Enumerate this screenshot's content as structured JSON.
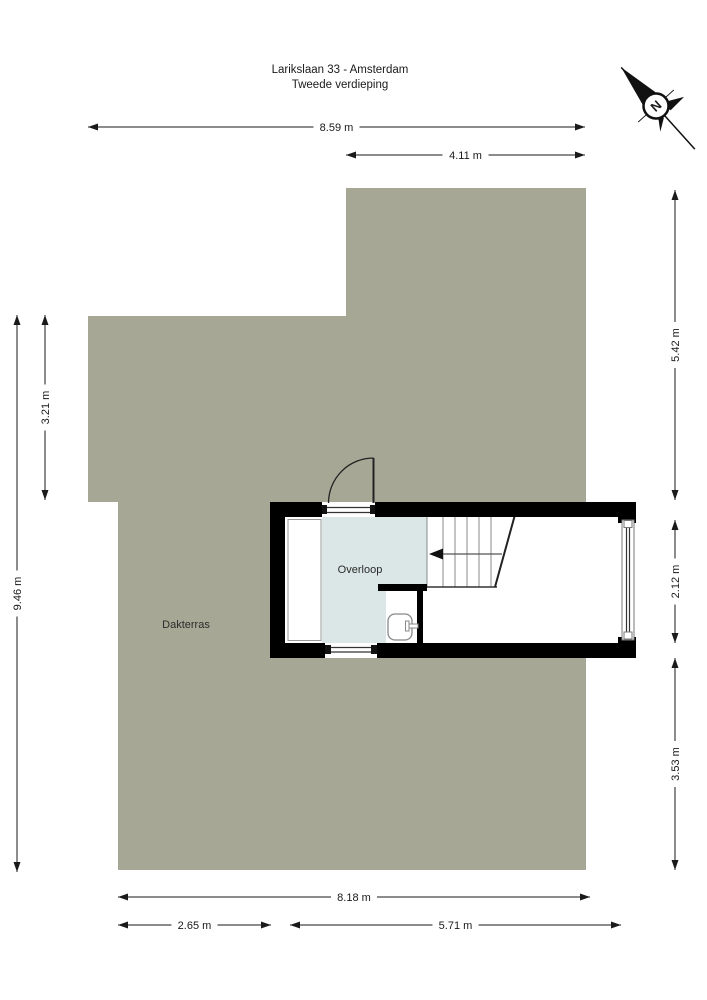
{
  "title": {
    "line1": "Larikslaan 33 - Amsterdam",
    "line2": "Tweede verdieping"
  },
  "compass": {
    "north_label": "N"
  },
  "rooms": {
    "dakterras": {
      "label": "Dakterras"
    },
    "overloop": {
      "label": "Overloop"
    }
  },
  "dimensions": {
    "width_total": {
      "label": "8.59 m"
    },
    "width_upper": {
      "label": "4.11 m"
    },
    "height_left_total": {
      "label": "9.46 m"
    },
    "height_left_upper": {
      "label": "3.21 m"
    },
    "height_right_upper": {
      "label": "5.42 m"
    },
    "height_right_mid": {
      "label": "2.12 m"
    },
    "height_right_lower": {
      "label": "3.53 m"
    },
    "width_bottom_total": {
      "label": "8.18 m"
    },
    "width_bottom_left": {
      "label": "2.65 m"
    },
    "width_bottom_right": {
      "label": "5.71 m"
    }
  },
  "colors": {
    "terrace": "#a6a895",
    "room_fill": "#dbe7e6",
    "wall": "#000000",
    "background": "#ffffff"
  }
}
